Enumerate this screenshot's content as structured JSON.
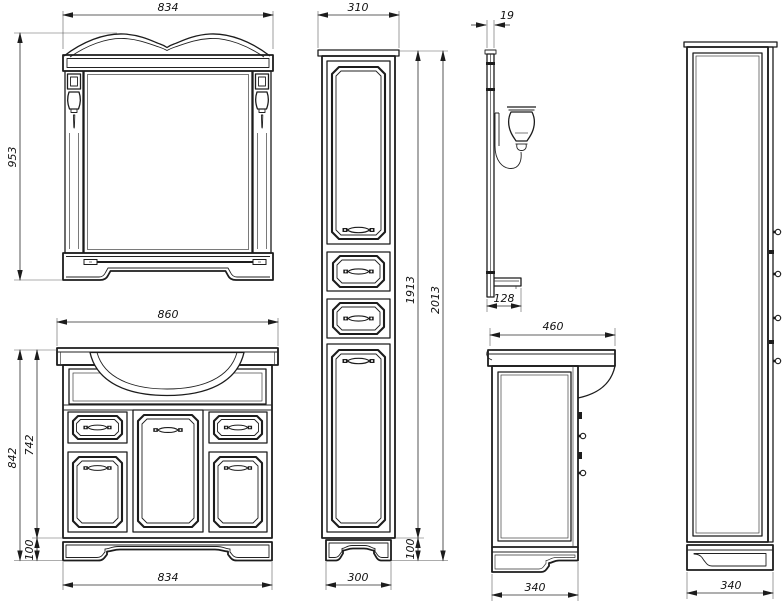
{
  "dims": {
    "mirror_width": "834",
    "mirror_height": "953",
    "vanity_width": "860",
    "vanity_height": "842",
    "vanity_body_height": "742",
    "vanity_plinth_height": "100",
    "vanity_base_width": "834",
    "column_width": "310",
    "column_body_height": "1913",
    "column_height": "2013",
    "column_plinth_height": "100",
    "column_base_width": "300",
    "mirror_depth": "19",
    "mirror_shelf_depth": "128",
    "vanity_depth": "460",
    "vanity_base_depth": "340",
    "column_depth": "340"
  }
}
